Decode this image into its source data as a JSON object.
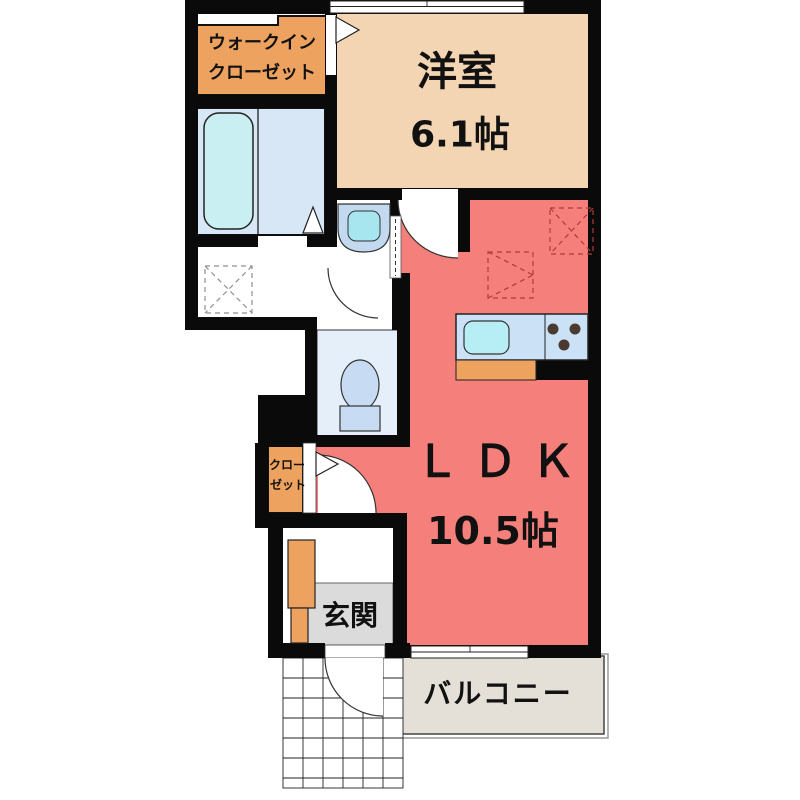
{
  "floorplan": {
    "title": "1K apartment floor plan",
    "rooms": {
      "walk_in_closet": {
        "label_line1": "ウォークイン",
        "label_line2": "クローゼット"
      },
      "western_room": {
        "name": "洋室",
        "size": "6.1帖"
      },
      "ldk": {
        "name": "ＬＤＫ",
        "size": "10.5帖"
      },
      "closet": {
        "label_line1": "クロー",
        "label_line2": "ゼット"
      },
      "entrance": {
        "name": "玄関"
      },
      "balcony": {
        "name": "バルコニー"
      }
    },
    "colors": {
      "wall": "#0a0a0a",
      "orange": "#eda35f",
      "tan": "#f3d4b3",
      "ldk_pink": "#f5807b",
      "bath_room": "#d8e7f6",
      "bathtub": "#c9eff3",
      "toilet_room": "#e5effa",
      "fixture_blue": "#c7dcf3",
      "basin_outer": "#c2d9f0",
      "basin_inner": "#a7e6ef",
      "counter": "#cbe1f6",
      "sink": "#b7edf5",
      "genkan_floor": "#dbdbdb",
      "balcony_floor": "#e4e0d8",
      "dashed_red": "#b03a34",
      "dashed_gray": "#8f8f8f",
      "burner": "#4b3a2f"
    }
  }
}
